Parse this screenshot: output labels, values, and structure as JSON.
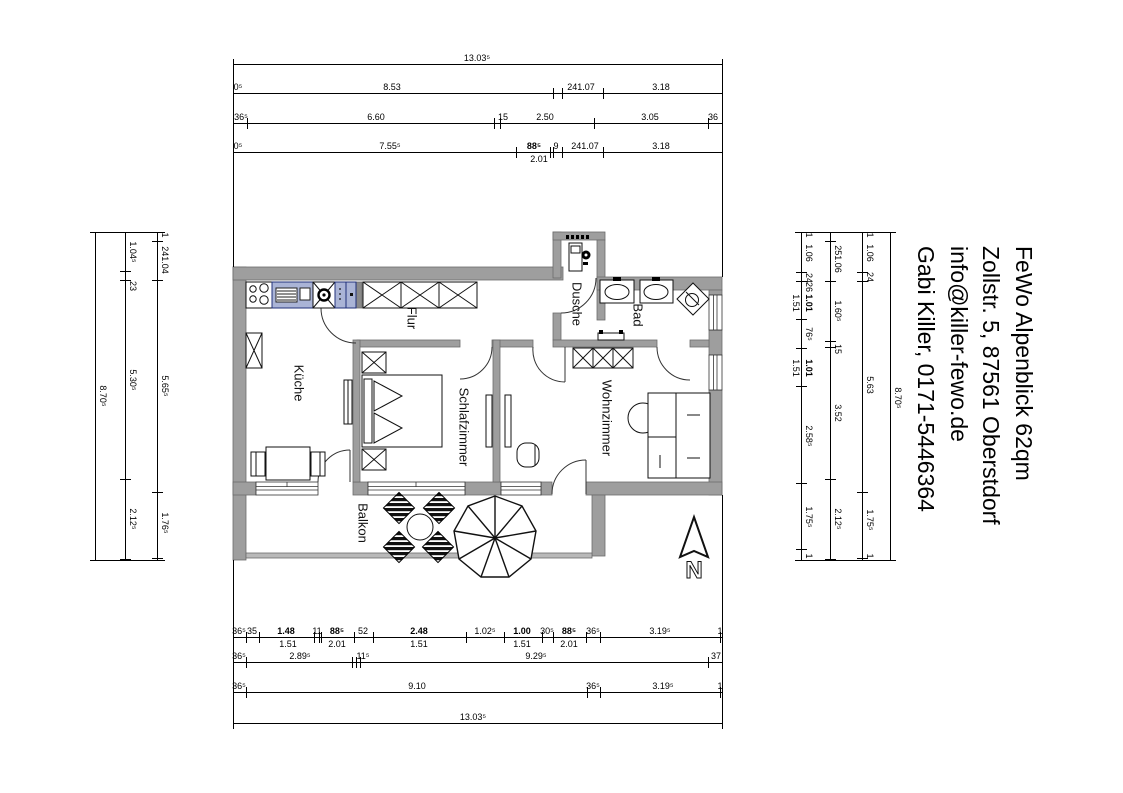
{
  "contact": {
    "lines": [
      "FeWo Alpenblick 62qm",
      "Zollstr. 5, 87561 Oberstdorf",
      "info@killer-fewo.de",
      "Gabi Killer, 0171-5446364"
    ]
  },
  "rooms": {
    "kueche": "Küche",
    "flur": "Flur",
    "schlafzimmer": "Schlafzimmer",
    "dusche": "Dusche",
    "bad": "Bad",
    "wohnzimmer": "Wohnzimmer",
    "balkon": "Balkon"
  },
  "north_label": "N",
  "dimensions": {
    "h": [
      {
        "y": 64,
        "x1": 233,
        "x2": 722,
        "ticks": [
          233,
          722
        ],
        "labels": [
          {
            "t": "13.03⁵",
            "x": 477
          }
        ]
      },
      {
        "y": 93,
        "x1": 233,
        "x2": 722,
        "ticks": [
          233,
          553,
          562,
          603,
          722
        ],
        "labels": [
          {
            "t": "0⁵",
            "x": 238
          },
          {
            "t": "8.53",
            "x": 392
          },
          {
            "t": "241.07",
            "x": 581
          },
          {
            "t": "3.18",
            "x": 661
          }
        ]
      },
      {
        "y": 123,
        "x1": 233,
        "x2": 722,
        "ticks": [
          233,
          247,
          494,
          500,
          594,
          708,
          722
        ],
        "labels": [
          {
            "t": "36⁵",
            "x": 241
          },
          {
            "t": "6.60",
            "x": 376
          },
          {
            "t": "15",
            "x": 503
          },
          {
            "t": "2.50",
            "x": 545
          },
          {
            "t": "3.05",
            "x": 650
          },
          {
            "t": "36",
            "x": 713
          }
        ]
      },
      {
        "y": 152,
        "x1": 233,
        "x2": 722,
        "ticks": [
          233,
          516,
          550,
          553,
          562,
          603,
          722
        ],
        "labels": [
          {
            "t": "0⁵",
            "x": 238
          },
          {
            "t": "7.55⁵",
            "x": 390
          },
          {
            "t": "88⁵",
            "x": 534,
            "b": 1
          },
          {
            "t": "9",
            "x": 556
          },
          {
            "t": "241.07",
            "x": 585
          },
          {
            "t": "3.18",
            "x": 661
          },
          {
            "t": "2.01",
            "x": 539,
            "below": 1
          }
        ]
      },
      {
        "y": 637,
        "x1": 233,
        "x2": 722,
        "ticks": [
          233,
          246,
          259,
          314,
          319,
          321,
          354,
          373,
          466,
          504,
          542,
          553,
          586,
          600,
          720,
          722
        ],
        "labels": [
          {
            "t": "36⁵",
            "x": 239
          },
          {
            "t": "35",
            "x": 252
          },
          {
            "t": "1.48",
            "x": 286,
            "b": 1
          },
          {
            "t": "11",
            "x": 317
          },
          {
            "t": "88⁵",
            "x": 337,
            "b": 1
          },
          {
            "t": "52",
            "x": 363
          },
          {
            "t": "2.48",
            "x": 419,
            "b": 1
          },
          {
            "t": "1.02⁵",
            "x": 485
          },
          {
            "t": "1.00",
            "x": 522,
            "b": 1
          },
          {
            "t": "30⁵",
            "x": 547
          },
          {
            "t": "88⁵",
            "x": 569,
            "b": 1
          },
          {
            "t": "36⁵",
            "x": 593
          },
          {
            "t": "3.19⁵",
            "x": 660
          },
          {
            "t": "1",
            "x": 720
          },
          {
            "t": "1.51",
            "x": 288,
            "below": 1
          },
          {
            "t": "2.01",
            "x": 337,
            "below": 1
          },
          {
            "t": "1.51",
            "x": 419,
            "below": 1
          },
          {
            "t": "1.51",
            "x": 522,
            "below": 1
          },
          {
            "t": "2.01",
            "x": 569,
            "below": 1
          }
        ]
      },
      {
        "y": 662,
        "x1": 233,
        "x2": 722,
        "ticks": [
          233,
          246,
          352,
          356,
          360,
          708,
          722
        ],
        "labels": [
          {
            "t": "36⁵",
            "x": 239
          },
          {
            "t": "2.89⁵",
            "x": 300
          },
          {
            "t": "11⁵",
            "x": 363
          },
          {
            "t": "9.29⁵",
            "x": 536
          },
          {
            "t": "37",
            "x": 716
          }
        ]
      },
      {
        "y": 692,
        "x1": 233,
        "x2": 722,
        "ticks": [
          233,
          246,
          587,
          600,
          720,
          722
        ],
        "labels": [
          {
            "t": "36⁵",
            "x": 239
          },
          {
            "t": "9.10",
            "x": 417
          },
          {
            "t": "36⁵",
            "x": 593
          },
          {
            "t": "3.19⁵",
            "x": 663
          },
          {
            "t": "1",
            "x": 720
          }
        ]
      },
      {
        "y": 723,
        "x1": 233,
        "x2": 722,
        "ticks": [
          233,
          722
        ],
        "labels": [
          {
            "t": "13.03⁵",
            "x": 473
          }
        ]
      },
      {
        "y": 232,
        "x1": 90,
        "x2": 165,
        "ticks": [],
        "labels": []
      },
      {
        "y": 560,
        "x1": 90,
        "x2": 165,
        "ticks": [],
        "labels": []
      },
      {
        "y": 232,
        "x1": 795,
        "x2": 895,
        "ticks": [],
        "labels": []
      },
      {
        "y": 560,
        "x1": 795,
        "x2": 895,
        "ticks": [],
        "labels": []
      }
    ],
    "v": [
      {
        "x": 95,
        "y1": 232,
        "y2": 560,
        "ticks": [
          232,
          560
        ],
        "labels": [
          {
            "t": "8.70⁵",
            "y": 396
          }
        ]
      },
      {
        "x": 125,
        "y1": 232,
        "y2": 560,
        "ticks": [
          232,
          271,
          280,
          479,
          559
        ],
        "labels": [
          {
            "t": "1.04⁵",
            "y": 252
          },
          {
            "t": "23",
            "y": 286
          },
          {
            "t": "5.30⁵",
            "y": 380
          },
          {
            "t": "2.12⁵",
            "y": 519
          }
        ]
      },
      {
        "x": 157,
        "y1": 232,
        "y2": 560,
        "ticks": [
          232,
          241,
          280,
          492,
          558
        ],
        "labels": [
          {
            "t": "1",
            "y": 235
          },
          {
            "t": "241.04",
            "y": 260
          },
          {
            "t": "5.65⁵",
            "y": 386
          },
          {
            "t": "1.76⁵",
            "y": 523
          }
        ]
      },
      {
        "x": 801,
        "y1": 232,
        "y2": 560,
        "ticks": [
          232,
          272,
          281,
          319,
          348,
          386,
          483,
          549,
          560
        ],
        "labels": [
          {
            "t": "1",
            "y": 235
          },
          {
            "t": "1.06",
            "y": 253
          },
          {
            "t": "24",
            "y": 278
          },
          {
            "t": "26",
            "y": 287
          },
          {
            "t": "1.01",
            "y": 303,
            "b": 1
          },
          {
            "t": "1.51",
            "y": 303,
            "dx": -13
          },
          {
            "t": "76⁵",
            "y": 334
          },
          {
            "t": "1.01",
            "y": 368,
            "b": 1
          },
          {
            "t": "1.51",
            "y": 368,
            "dx": -13
          },
          {
            "t": "2.58⁵",
            "y": 436
          },
          {
            "t": "1.75⁵",
            "y": 517
          },
          {
            "t": "1",
            "y": 556
          }
        ]
      },
      {
        "x": 830,
        "y1": 232,
        "y2": 560,
        "ticks": [
          232,
          241,
          281,
          341,
          347,
          479,
          559
        ],
        "labels": [
          {
            "t": "251.06",
            "y": 259
          },
          {
            "t": "1.60⁵",
            "y": 311
          },
          {
            "t": "15",
            "y": 349
          },
          {
            "t": "3.52",
            "y": 413
          },
          {
            "t": "2.12⁵",
            "y": 519
          }
        ]
      },
      {
        "x": 862,
        "y1": 232,
        "y2": 560,
        "ticks": [
          232,
          272,
          281,
          492,
          558
        ],
        "labels": [
          {
            "t": "1",
            "y": 235
          },
          {
            "t": "1.06",
            "y": 253
          },
          {
            "t": "24",
            "y": 277
          },
          {
            "t": "5.63",
            "y": 385
          },
          {
            "t": "1.75⁵",
            "y": 520
          },
          {
            "t": "1",
            "y": 556
          }
        ]
      },
      {
        "x": 890,
        "y1": 232,
        "y2": 560,
        "ticks": [
          232,
          560
        ],
        "labels": [
          {
            "t": "8.70⁵",
            "y": 398
          }
        ]
      },
      {
        "x": 233,
        "y1": 64,
        "y2": 267,
        "ticks": [],
        "labels": []
      },
      {
        "x": 722,
        "y1": 64,
        "y2": 277,
        "ticks": [],
        "labels": []
      },
      {
        "x": 233,
        "y1": 560,
        "y2": 723,
        "ticks": [],
        "labels": []
      },
      {
        "x": 722,
        "y1": 495,
        "y2": 723,
        "ticks": [],
        "labels": []
      }
    ]
  }
}
